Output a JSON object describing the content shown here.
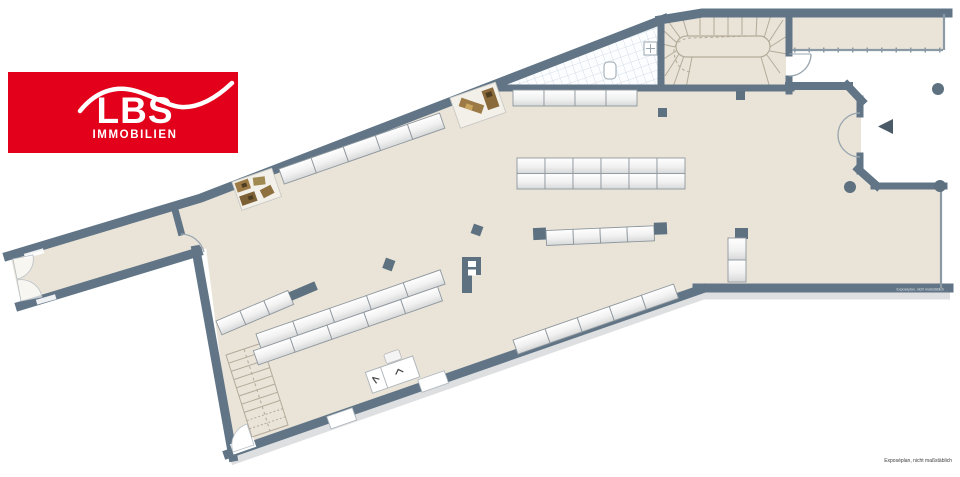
{
  "logo": {
    "brand": "LBS",
    "sub": "IMMOBILIEN",
    "bg_color": "#e2001a",
    "text_color": "#ffffff"
  },
  "plan": {
    "disclaimer": "Exposéplan, nicht maßstäblich",
    "wall_watermark": "Exposéplan, nicht maßstäblich",
    "colors": {
      "brand": "#e2001a",
      "wall": "#617586",
      "wallthin": "#8c9aa5",
      "floor": "#eae4d8",
      "tile_line": "#c9d5e2",
      "shelfline": "#8e979e",
      "accent": "#5d7181",
      "wood": "#9c7a45"
    }
  }
}
